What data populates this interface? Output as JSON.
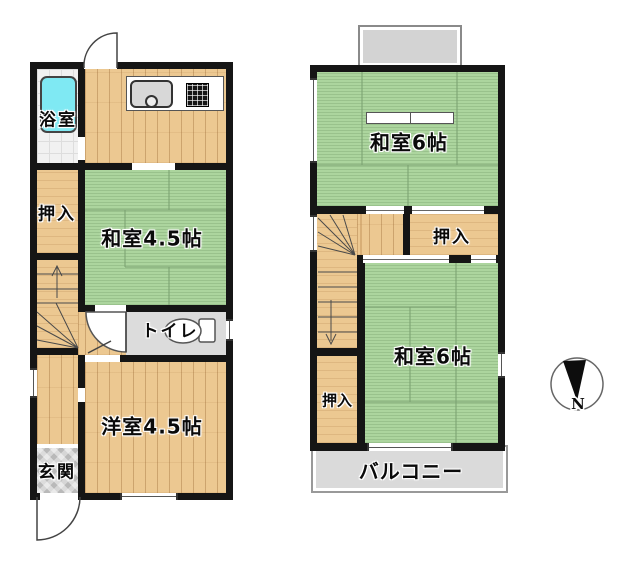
{
  "floor1": {
    "bath": "浴室",
    "closet": "押入",
    "tatami_room": "和室4.5帖",
    "toilet": "トイレ",
    "western_room": "洋室4.5帖",
    "entrance": "玄関"
  },
  "floor2": {
    "tatami_room_north": "和室6帖",
    "closet_north": "押入",
    "tatami_room_south": "和室6帖",
    "closet_south": "押入",
    "balcony": "バルコニー"
  },
  "compass": {
    "north": "N"
  },
  "colors": {
    "wall": "#151515",
    "tatami": "#acd59e",
    "tatami-line": "#79a06f",
    "wood": "#ecc891",
    "wood-line": "#c3955c",
    "tub": "#7fe9f3",
    "bath-tile": "#f1f1f1",
    "toilet-floor": "#dcdcdc",
    "entry-tile": "#d6d6d6",
    "balcony": "#dadada",
    "roof": "#d3d3d3"
  }
}
